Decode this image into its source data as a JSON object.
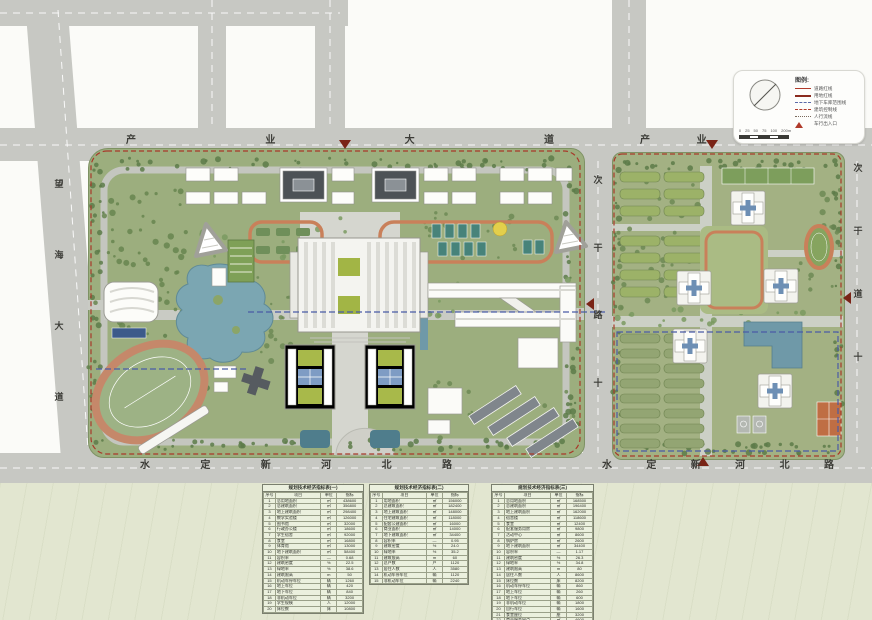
{
  "roads": {
    "industry_avenue": "产业大道",
    "industry_avenue_right": "产业大道",
    "wanghai_avenue": "望海大道",
    "shuiding_left": "水定新河北路",
    "shuiding_right": "水定新河北路",
    "middle_secondary": "次干路十",
    "east_secondary": "次干道十"
  },
  "legend": {
    "header": "图例:",
    "items": [
      {
        "label": "道路红线",
        "style": "solid-thin",
        "color": "#b03a2a"
      },
      {
        "label": "用地红线",
        "style": "solid-thick",
        "color": "#8a2a1e"
      },
      {
        "label": "地下车库范围线",
        "style": "dash-blue",
        "color": "#5a6aa8"
      },
      {
        "label": "建筑控制线",
        "style": "dash-red",
        "color": "#b03a2a"
      },
      {
        "label": "人行流线",
        "style": "dot",
        "color": "#7a6a5c"
      },
      {
        "label": "车行出入口",
        "style": "triangle",
        "color": "#b03a2a"
      }
    ],
    "scale_labels": [
      "0",
      "25",
      "50",
      "75",
      "100",
      "200m"
    ]
  },
  "tables": [
    {
      "title": "规划技术经济指标表(一)",
      "headers": [
        "序号",
        "项目",
        "单位",
        "指标"
      ],
      "rows": [
        [
          "1",
          "总用地面积",
          "㎡",
          "438600"
        ],
        [
          "2",
          "总建筑面积",
          "㎡",
          "356800"
        ],
        [
          "3",
          "地上建筑面积",
          "㎡",
          "298400"
        ],
        [
          "4",
          "教学实验楼",
          "㎡",
          "126000"
        ],
        [
          "5",
          "图书馆",
          "㎡",
          "32000"
        ],
        [
          "6",
          "行政办公楼",
          "㎡",
          "18600"
        ],
        [
          "7",
          "学生宿舍",
          "㎡",
          "92000"
        ],
        [
          "8",
          "食堂",
          "㎡",
          "16800"
        ],
        [
          "9",
          "体育馆",
          "㎡",
          "13000"
        ],
        [
          "10",
          "地下建筑面积",
          "㎡",
          "58400"
        ],
        [
          "11",
          "容积率",
          "—",
          "0.68"
        ],
        [
          "12",
          "建筑密度",
          "%",
          "22.5"
        ],
        [
          "13",
          "绿地率",
          "%",
          "38.6"
        ],
        [
          "14",
          "建筑限高",
          "m",
          "50"
        ],
        [
          "15",
          "机动车停车位",
          "辆",
          "1260"
        ],
        [
          "16",
          "地上车位",
          "辆",
          "420"
        ],
        [
          "17",
          "地下车位",
          "辆",
          "840"
        ],
        [
          "18",
          "非机动车位",
          "辆",
          "3200"
        ],
        [
          "19",
          "学生规模",
          "人",
          "12000"
        ],
        [
          "20",
          "床位数",
          "床",
          "10800"
        ]
      ]
    },
    {
      "title": "规划技术经济指标表(二)",
      "headers": [
        "序号",
        "项目",
        "单位",
        "指标"
      ],
      "rows": [
        [
          "1",
          "用地面积",
          "㎡",
          "156000"
        ],
        [
          "2",
          "总建筑面积",
          "㎡",
          "182400"
        ],
        [
          "3",
          "地上建筑面积",
          "㎡",
          "148000"
        ],
        [
          "4",
          "住宅建筑面积",
          "㎡",
          "118000"
        ],
        [
          "5",
          "配套公建面积",
          "㎡",
          "16000"
        ],
        [
          "6",
          "商业面积",
          "㎡",
          "14000"
        ],
        [
          "7",
          "地下建筑面积",
          "㎡",
          "34400"
        ],
        [
          "8",
          "容积率",
          "—",
          "0.95"
        ],
        [
          "9",
          "建筑密度",
          "%",
          "24.0"
        ],
        [
          "10",
          "绿地率",
          "%",
          "35.2"
        ],
        [
          "11",
          "建筑限高",
          "m",
          "60"
        ],
        [
          "12",
          "总户数",
          "户",
          "1120"
        ],
        [
          "13",
          "居住人数",
          "人",
          "3580"
        ],
        [
          "14",
          "机动车停车位",
          "辆",
          "1120"
        ],
        [
          "15",
          "非机动车位",
          "辆",
          "2240"
        ]
      ]
    },
    {
      "title": "规划技术经济指标表(三)",
      "headers": [
        "序号",
        "项目",
        "单位",
        "指标"
      ],
      "rows": [
        [
          "1",
          "总用地面积",
          "㎡",
          "168500"
        ],
        [
          "2",
          "总建筑面积",
          "㎡",
          "196400"
        ],
        [
          "3",
          "地上建筑面积",
          "㎡",
          "162000"
        ],
        [
          "4",
          "宿舍楼",
          "㎡",
          "118600"
        ],
        [
          "5",
          "食堂",
          "㎡",
          "12400"
        ],
        [
          "6",
          "配套服务用房",
          "㎡",
          "9800"
        ],
        [
          "7",
          "活动中心",
          "㎡",
          "8600"
        ],
        [
          "8",
          "锅炉房",
          "㎡",
          "2600"
        ],
        [
          "9",
          "地下建筑面积",
          "㎡",
          "34400"
        ],
        [
          "10",
          "容积率",
          "—",
          "1.17"
        ],
        [
          "11",
          "建筑密度",
          "%",
          "26.3"
        ],
        [
          "12",
          "绿地率",
          "%",
          "34.8"
        ],
        [
          "13",
          "建筑限高",
          "m",
          "80"
        ],
        [
          "14",
          "居住人数",
          "人",
          "8600"
        ],
        [
          "15",
          "床位数",
          "床",
          "8200"
        ],
        [
          "16",
          "机动车停车位",
          "辆",
          "860"
        ],
        [
          "17",
          "地上车位",
          "辆",
          "260"
        ],
        [
          "18",
          "地下车位",
          "辆",
          "600"
        ],
        [
          "19",
          "非机动车位",
          "辆",
          "1800"
        ],
        [
          "20",
          "自行车位",
          "辆",
          "1600"
        ],
        [
          "21",
          "食堂座位",
          "座",
          "3200"
        ],
        [
          "22",
          "商业服务网点",
          "㎡",
          "4600"
        ],
        [
          "23",
          "门卫用房",
          "㎡",
          "180"
        ],
        [
          "24",
          "垃圾收集点",
          "处",
          "4"
        ]
      ]
    }
  ]
}
